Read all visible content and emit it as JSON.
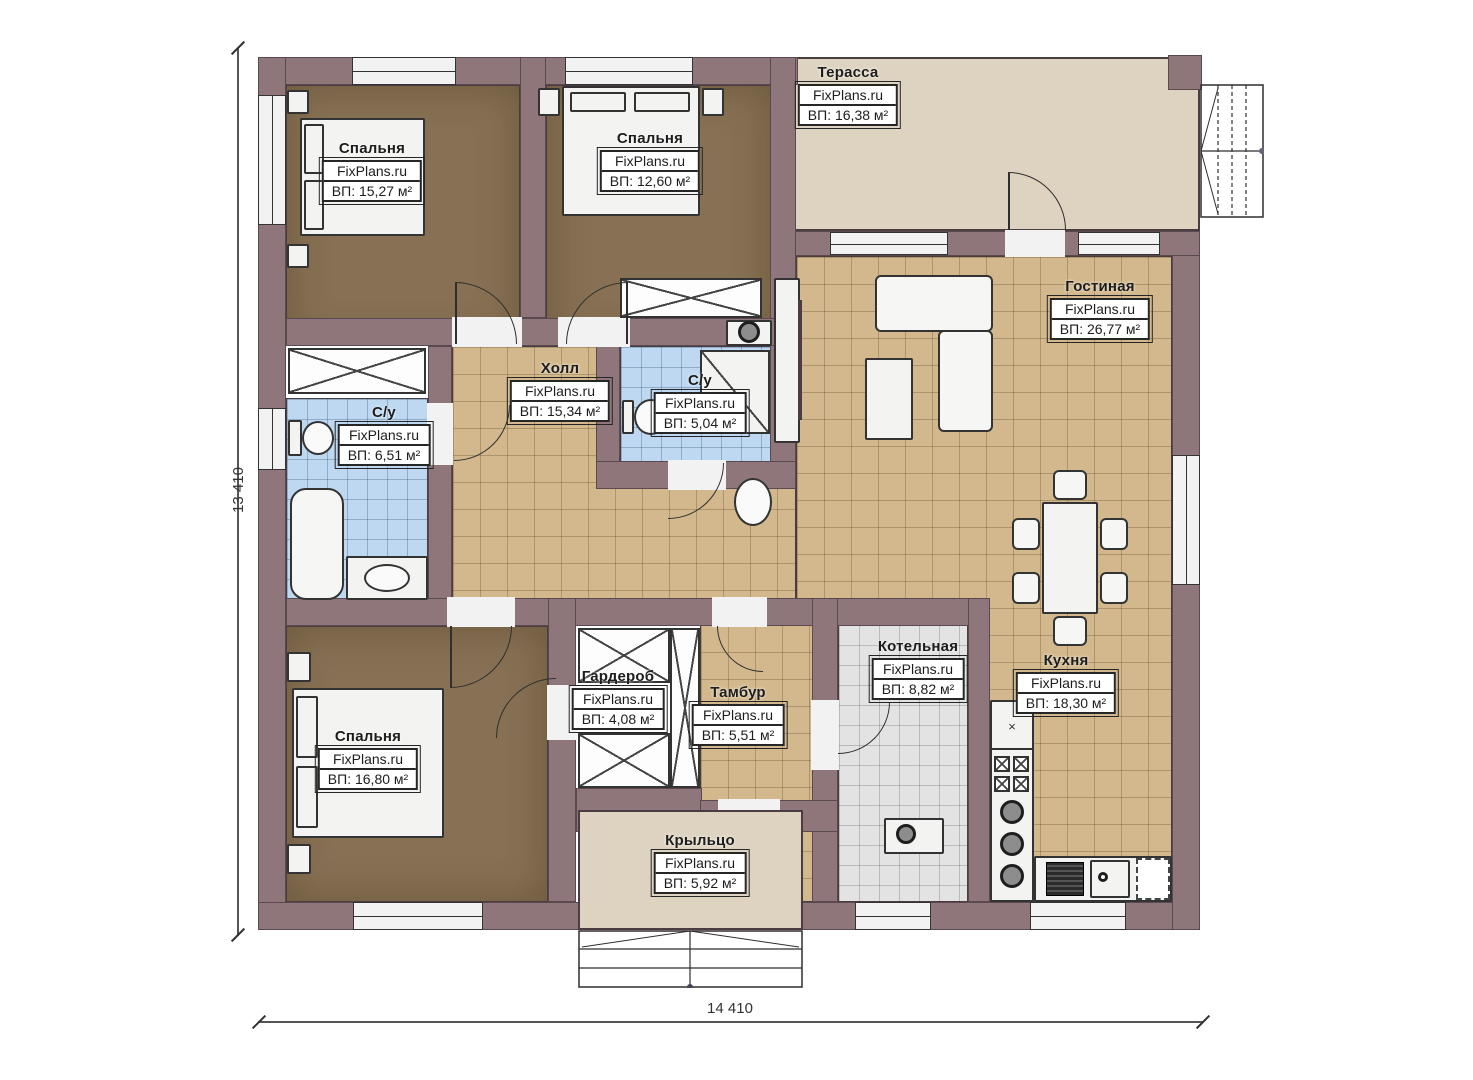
{
  "plan": {
    "dimension_left": "13 410",
    "dimension_bottom": "14 410",
    "rooms": [
      {
        "id": "terrace",
        "name": "Терасса",
        "brand": "FixPlans.ru",
        "area": "ВП: 16,38 м²"
      },
      {
        "id": "bedroom-1",
        "name": "Спальня",
        "brand": "FixPlans.ru",
        "area": "ВП: 15,27 м²"
      },
      {
        "id": "bedroom-2",
        "name": "Спальня",
        "brand": "FixPlans.ru",
        "area": "ВП: 12,60 м²"
      },
      {
        "id": "living-room",
        "name": "Гостиная",
        "brand": "FixPlans.ru",
        "area": "ВП: 26,77 м²"
      },
      {
        "id": "hall",
        "name": "Холл",
        "brand": "FixPlans.ru",
        "area": "ВП: 15,34 м²"
      },
      {
        "id": "bathroom-2",
        "name": "С/у",
        "brand": "FixPlans.ru",
        "area": "ВП: 5,04 м²"
      },
      {
        "id": "bathroom-1",
        "name": "С/у",
        "brand": "FixPlans.ru",
        "area": "ВП: 6,51 м²"
      },
      {
        "id": "bedroom-3",
        "name": "Спальня",
        "brand": "FixPlans.ru",
        "area": "ВП: 16,80 м²"
      },
      {
        "id": "wardrobe",
        "name": "Гардероб",
        "brand": "FixPlans.ru",
        "area": "ВП: 4,08 м²"
      },
      {
        "id": "tambour",
        "name": "Тамбур",
        "brand": "FixPlans.ru",
        "area": "ВП: 5,51 м²"
      },
      {
        "id": "boiler",
        "name": "Котельная",
        "brand": "FixPlans.ru",
        "area": "ВП: 8,82 м²"
      },
      {
        "id": "kitchen",
        "name": "Кухня",
        "brand": "FixPlans.ru",
        "area": "ВП: 18,30 м²"
      },
      {
        "id": "porch",
        "name": "Крыльцо",
        "brand": "FixPlans.ru",
        "area": "ВП: 5,92 м²"
      }
    ],
    "colors": {
      "wall": "#8e767b",
      "bedroom_floor": "#877053",
      "tile_tan": "#d2b88c",
      "tile_blue": "#bdd8f0",
      "tile_gray": "#e3e3e3",
      "deck": "#ded3c0"
    }
  }
}
